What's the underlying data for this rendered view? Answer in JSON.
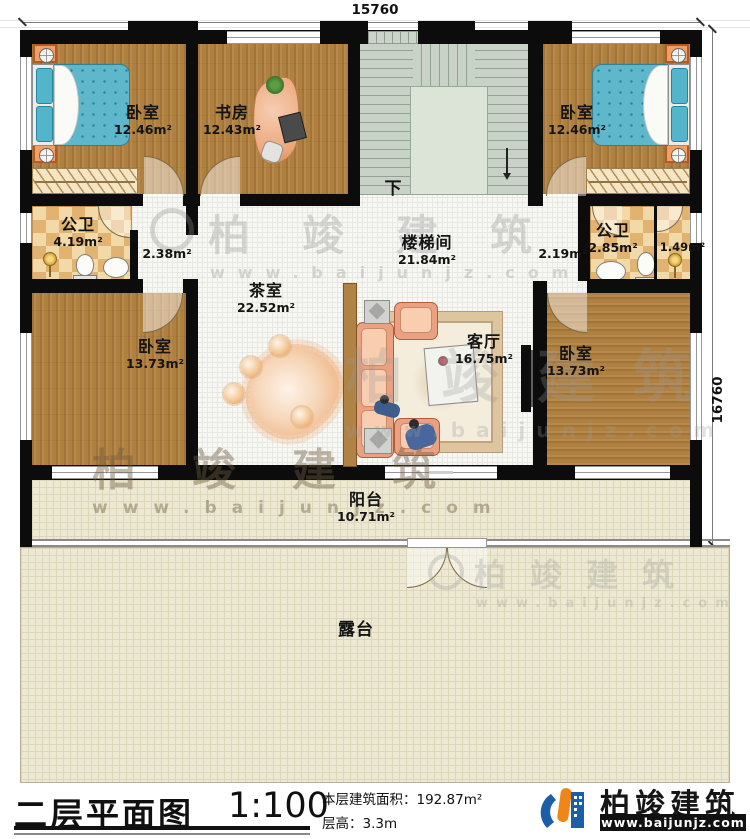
{
  "dimensions": {
    "top": "15760",
    "right": "16760"
  },
  "rooms": [
    {
      "name": "卧室",
      "area": "12.46m²"
    },
    {
      "name": "书房",
      "area": "12.43m²"
    },
    {
      "name": "卧室",
      "area": "12.46m²"
    },
    {
      "name": "公卫",
      "area": "4.19m²"
    },
    {
      "name": "楼梯间",
      "area": "21.84m²"
    },
    {
      "name": "公卫",
      "area": "2.85m²"
    },
    {
      "name": "茶室",
      "area": "22.52m²"
    },
    {
      "name": "客厅",
      "area": "16.75m²"
    },
    {
      "name": "卧室",
      "area": "13.73m²"
    },
    {
      "name": "卧室",
      "area": "13.73m²"
    },
    {
      "name": "阳台",
      "area": "10.71m²"
    },
    {
      "name": "露台"
    }
  ],
  "passage_areas": {
    "left": "2.38m²",
    "right": "2.19m²",
    "closet": "1.49m²"
  },
  "stairs": {
    "down_label": "下"
  },
  "watermark": {
    "text": "柏竣建筑",
    "url": "www.baijunjz.com"
  },
  "title_block": {
    "plan_title": "二层平面图",
    "scale": "1:100",
    "area_label": "本层建筑面积：",
    "area_value": "192.87m²",
    "height_label": "层高：",
    "height_value": "3.3m"
  },
  "brand": {
    "name": "柏竣建筑",
    "url": "www.baijunjz.com",
    "blue": "#1c5fa8",
    "orange": "#f08519"
  }
}
